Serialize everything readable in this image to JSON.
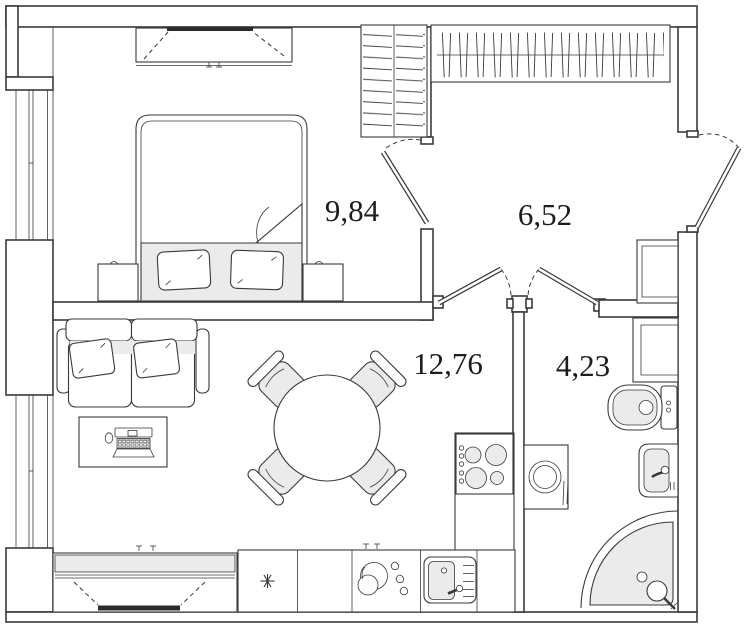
{
  "plan": {
    "type": "apartment-floor-plan",
    "rooms": {
      "bedroom": {
        "area": "9,84"
      },
      "hallway": {
        "area": "6,52"
      },
      "living_kitchen": {
        "area": "12,76"
      },
      "bathroom": {
        "area": "4,23"
      }
    },
    "fixtures": {
      "bedroom": [
        "tv-stand-icon",
        "double-bed-icon",
        "nightstand-icon",
        "nightstand-icon",
        "shelf-wardrobe-icon",
        "window-icon"
      ],
      "hallway": [
        "hanger-wardrobe-icon",
        "entrance-door-icon",
        "duct-shaft-icon"
      ],
      "living_kitchen": [
        "sofa-icon",
        "desk-laptop-icon",
        "round-table-icon",
        "chair-icon",
        "stove-icon",
        "fridge-icon",
        "kitchen-sink-icon",
        "tv-cabinet-icon",
        "window-icon"
      ],
      "bathroom": [
        "washing-machine-icon",
        "toilet-icon",
        "washbasin-icon",
        "corner-shower-icon",
        "duct-shaft-icon"
      ]
    },
    "colors": {
      "line": "#3a3a3a",
      "wall_fill": "#ffffff",
      "light_fill": "#ebebeb",
      "tv_black": "#2c2c2c",
      "background": "#ffffff"
    }
  }
}
